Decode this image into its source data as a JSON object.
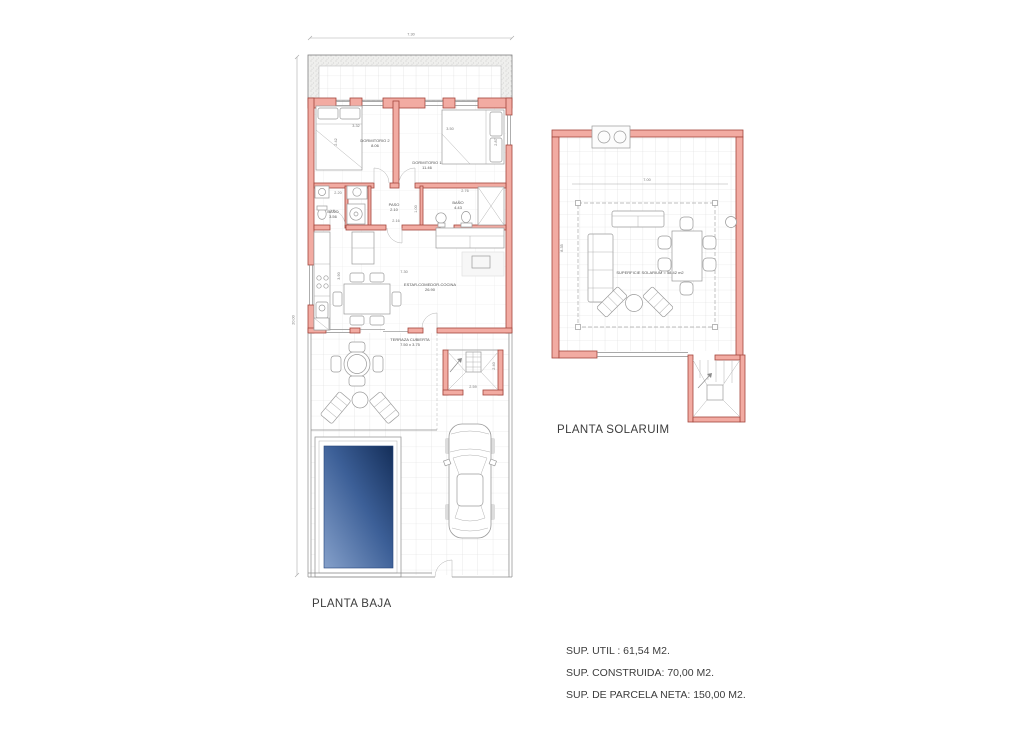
{
  "colors": {
    "wall_fill": "#f2aba2",
    "wall_stroke": "#a3453c",
    "pool_light": "#85a0ca",
    "pool_dark": "#142e59",
    "line_grey": "#8c8c8c"
  },
  "baja": {
    "title": "PLANTA BAJA",
    "dim_width": "7.30",
    "dim_height": "20.00",
    "dorm2": {
      "name": "DORMITORIO 2",
      "area": "8.06",
      "d1": "3.32",
      "d2": "2.42"
    },
    "dorm1": {
      "name": "DORMITORIO 1",
      "area": "11.46",
      "d1": "3.50",
      "d2": "2.87"
    },
    "bano1": {
      "name": "BAÑO",
      "area": "3.56",
      "d1": "2.20"
    },
    "paso": {
      "name": "PASO",
      "area": "2.10",
      "d1": "2.16",
      "d2": "1.00"
    },
    "bano2": {
      "name": "BAÑO",
      "area": "4.43",
      "d1": "2.76"
    },
    "estar": {
      "name": "ESTAR-COMEDOR-COCINA",
      "area": "26.90",
      "d1": "7.30",
      "d2": "3.90"
    },
    "terraza": {
      "name": "TERRAZA CUBIERTA",
      "area": "7.50 x 3.75"
    },
    "stairs": {
      "d1": "2.59",
      "d2": "2.40"
    }
  },
  "solarium": {
    "title": "PLANTA SOLARUIM",
    "surface": "SUPERFICIE SOLARIUM = 58.42 m2",
    "dim_width": "7.00",
    "dim_height": "8.35"
  },
  "summary": {
    "line1": "SUP. UTIL : 61,54 M2.",
    "line2": "SUP. CONSTRUIDA: 70,00 M2.",
    "line3": "SUP. DE PARCELA NETA: 150,00 M2."
  }
}
